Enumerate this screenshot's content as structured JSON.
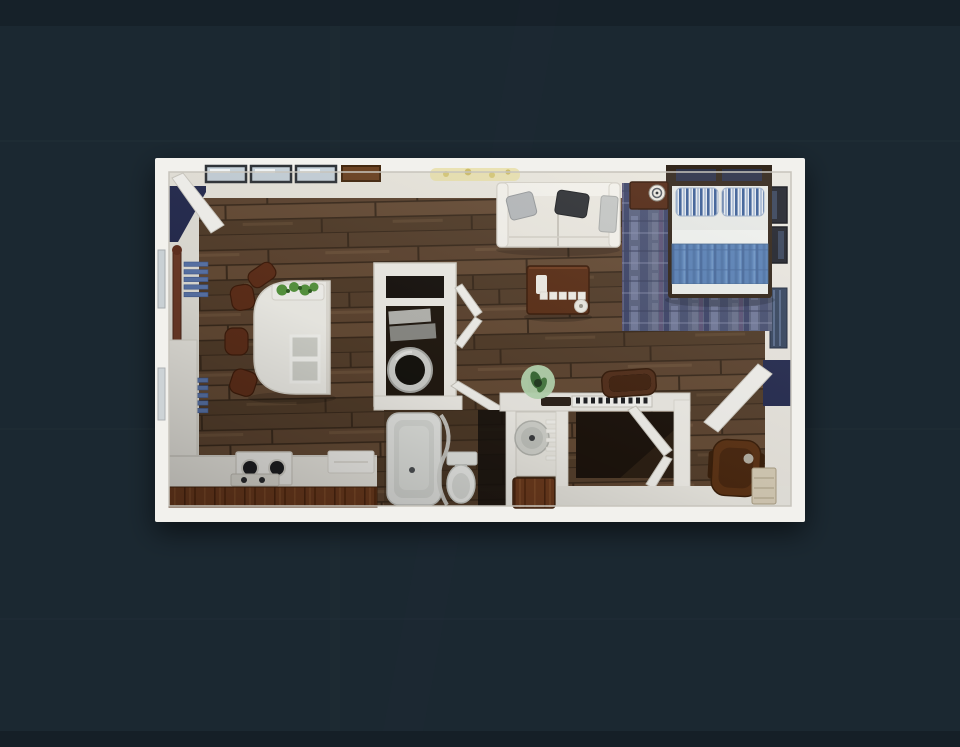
{
  "scene": {
    "kind": "3d-rendered floor plan, top-down view, studio apartment on dark textured backdrop",
    "rooms": [
      "living-dining-area",
      "kitchen",
      "sleeping-area",
      "bathroom",
      "laundry-closet",
      "closet-nook",
      "entry"
    ]
  },
  "colors": {
    "background": "#1b2831",
    "background_shade": "#151f27",
    "wall": "#f2f1ed",
    "wall_inner": "#e9e6dd",
    "floor_wood": "#5e4531",
    "floor_wood_dark": "#3f2e20",
    "cabinet_wood": "#6d3b1e",
    "rug_blue": "#5c6480",
    "bed_blanket": "#5b82b6",
    "pillow_stripe": "#3d5f96",
    "radiator_blue": "#5b76ab",
    "doorway_navy": "#262c50",
    "furniture_brown": "#5c3018",
    "upholstery_cream": "#ebe8e0",
    "plant_green": "#57963f",
    "decor_yellow": "#e9e0ac",
    "appliance_dark": "#1e1f22"
  },
  "items": {
    "sofa": "three-seat sofa with two throw pillows",
    "coffee_table": "dark wood coffee table with remote and coasters",
    "nightstand": "nightstand with round clock",
    "bed": "bed with striped pillows and blue blanket",
    "rug": "mottled blue area rug",
    "island": "white dining island with planter and two inset trays",
    "stools": "four wooden stools",
    "stove": "two-burner stove on counter",
    "counters": "kitchen counter with wood cabinets",
    "washer_closet": "laundry closet with washer and linen shelves, bifold doors",
    "bathtub": "bathtub with shower curtain",
    "toilet": "toilet",
    "vanity": "vanity with round basin and wood cabinet",
    "desk": "white desk with keyboard, plant and mat",
    "desk_chair": "brown leather desk chair",
    "office_chair": "brown office chair",
    "dresser": "small light-wood dresser",
    "radiator": "two blue slatted radiator panels",
    "curtain_rod": "dark wood rod on window wall",
    "windows": "three top-wall windows and picture frame",
    "frames": "framed art on right wall",
    "entry_door": "open entry door with dark doorway"
  }
}
